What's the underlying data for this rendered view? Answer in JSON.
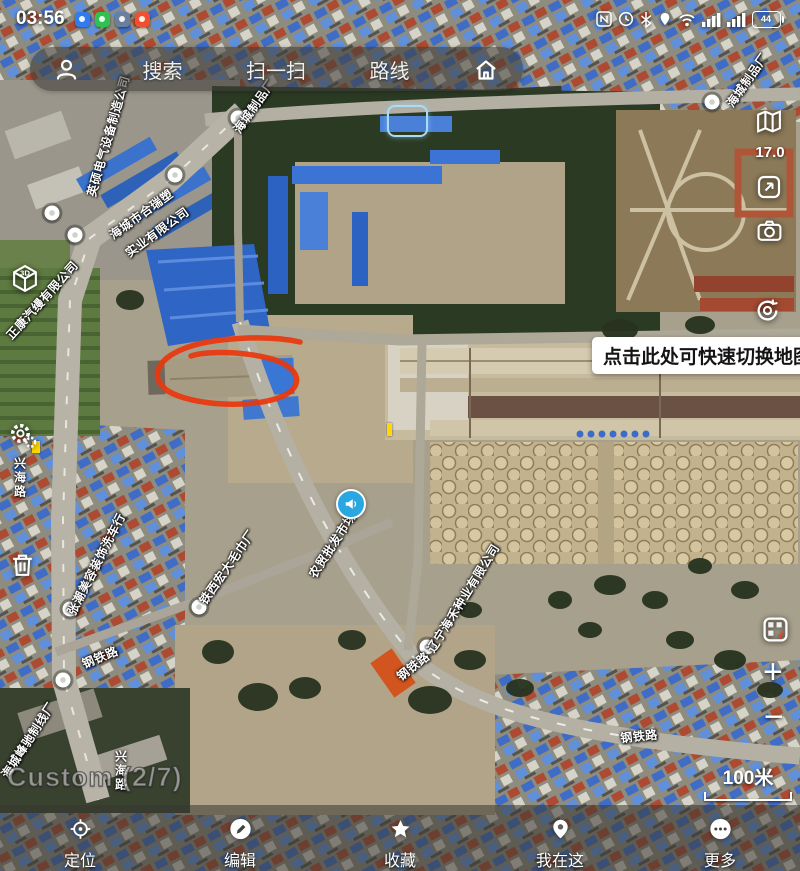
{
  "status_bar": {
    "time": "03:56",
    "battery_percent": "44",
    "right_icon_names": [
      "nfc-icon",
      "clock-icon",
      "bluetooth-icon",
      "location-icon",
      "wifi-icon",
      "signal-icon",
      "signal-icon",
      "battery-icon"
    ]
  },
  "search_bar": {
    "search": "搜索",
    "scan": "扫一扫",
    "route": "路线",
    "icon_names": [
      "user-icon",
      "home-icon"
    ]
  },
  "map_controls": {
    "zoom_level": "17.0",
    "tooltip": "点击此处可快速切换地图",
    "zoom_in": "+",
    "zoom_out": "−",
    "right_icon_names": [
      "map-layers-icon",
      "screenshot-icon",
      "camera-icon",
      "camera-rotate-icon",
      "map-switch-icon"
    ],
    "left_icon_names": [
      "cube-3d-icon",
      "settings-gear-icon",
      "trash-icon"
    ]
  },
  "map_overlay": {
    "watermark": "Custom (2/7)",
    "scale": "100米"
  },
  "map_labels": {
    "poi": [
      {
        "text": "英硕电气设备制造公司"
      },
      {
        "text": "海城市合瑞塑"
      },
      {
        "text": "实业有限公司"
      },
      {
        "text": "海城制品厂"
      },
      {
        "text": "海城制品厂"
      },
      {
        "text": "正康汽缦有限公司"
      },
      {
        "text": "张潮美容装饰洗车行"
      },
      {
        "text": "铁西宏大毛巾厂"
      },
      {
        "text": "农贸批发市场"
      },
      {
        "text": "辽宁海禾种业有限公司"
      },
      {
        "text": "海城峰驰制线厂"
      }
    ],
    "roads": [
      {
        "text": "钢铁路"
      },
      {
        "text": "钢铁路"
      },
      {
        "text": "钢铁路"
      },
      {
        "text": "兴海路"
      },
      {
        "text": "兴海路"
      }
    ]
  },
  "bottom_nav": {
    "items": [
      {
        "label": "定位",
        "icon": "locate-icon"
      },
      {
        "label": "编辑",
        "icon": "edit-icon"
      },
      {
        "label": "收藏",
        "icon": "star-icon"
      },
      {
        "label": "我在这",
        "icon": "pin-icon"
      },
      {
        "label": "更多",
        "icon": "more-icon"
      }
    ]
  },
  "colors": {
    "annotation_red": "#e8380d",
    "marker_blue": "#29a7e0",
    "highlight_blue": "#a9dcf7",
    "roof_blue": "#3a72cc",
    "construction_orange": "#d2541e"
  }
}
